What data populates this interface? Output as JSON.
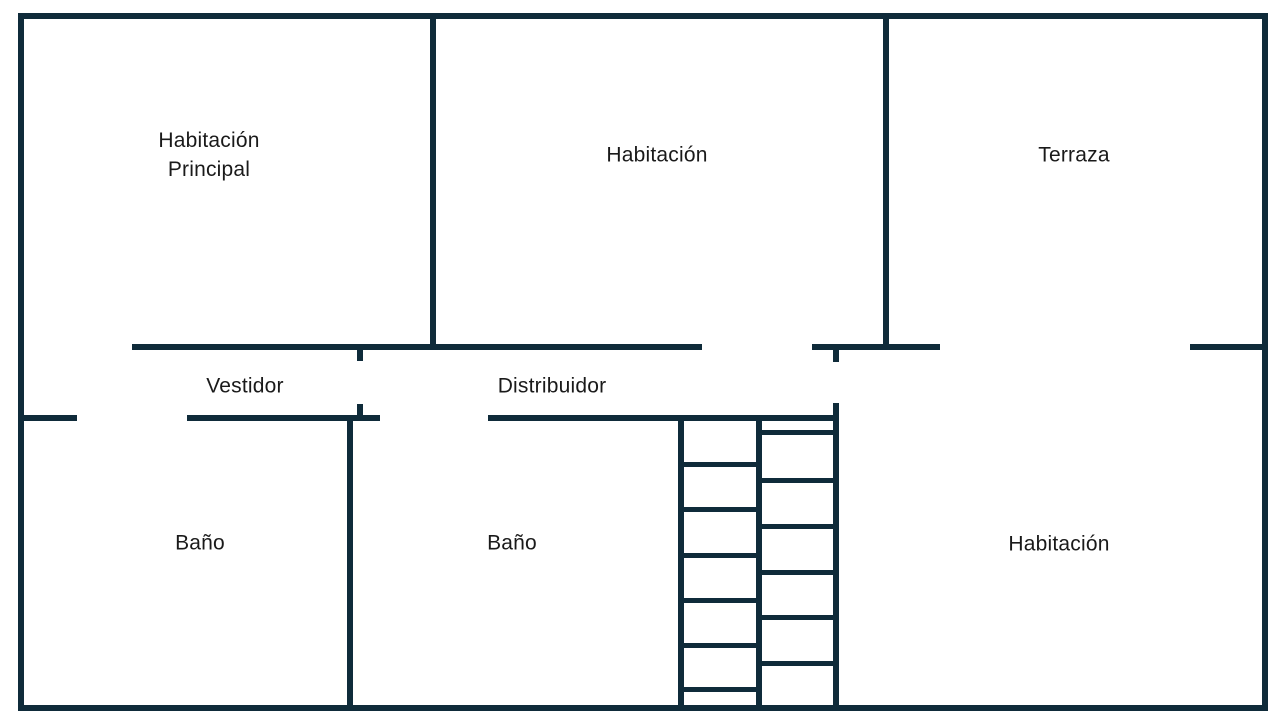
{
  "colors": {
    "wall": "#0F2B3A",
    "label_text": "#1A1A1A",
    "background": "#FFFFFF"
  },
  "rooms": [
    {
      "name": "habitacion-principal",
      "lines": [
        "Habitación",
        "Principal"
      ],
      "cx": 209,
      "cy": 155
    },
    {
      "name": "habitacion-superior",
      "lines": [
        "Habitación"
      ],
      "cx": 657,
      "cy": 155
    },
    {
      "name": "terraza",
      "lines": [
        "Terraza"
      ],
      "cx": 1074,
      "cy": 155
    },
    {
      "name": "vestidor",
      "lines": [
        "Vestidor"
      ],
      "cx": 245,
      "cy": 386
    },
    {
      "name": "distribuidor",
      "lines": [
        "Distribuidor"
      ],
      "cx": 552,
      "cy": 386
    },
    {
      "name": "bano-izquierdo",
      "lines": [
        "Baño"
      ],
      "cx": 200,
      "cy": 543
    },
    {
      "name": "bano-centro",
      "lines": [
        "Baño"
      ],
      "cx": 512,
      "cy": 543
    },
    {
      "name": "habitacion-inferior",
      "lines": [
        "Habitación"
      ],
      "cx": 1059,
      "cy": 544
    }
  ],
  "floorplan": {
    "walls": [
      {
        "name": "outer-wall-top",
        "x": 18,
        "y": 13,
        "w": 1250,
        "h": 6
      },
      {
        "name": "outer-wall-bottom",
        "x": 18,
        "y": 705,
        "w": 1250,
        "h": 6
      },
      {
        "name": "outer-wall-left",
        "x": 18,
        "y": 13,
        "w": 6,
        "h": 698
      },
      {
        "name": "outer-wall-right",
        "x": 1262,
        "y": 13,
        "w": 6,
        "h": 698
      },
      {
        "name": "wall-principal-habitacion",
        "x": 430,
        "y": 13,
        "w": 6,
        "h": 337
      },
      {
        "name": "wall-habitacion-terraza",
        "x": 883,
        "y": 13,
        "w": 6,
        "h": 337
      },
      {
        "name": "wall-toprow-left",
        "x": 132,
        "y": 344,
        "w": 570,
        "h": 6
      },
      {
        "name": "wall-toprow-middle",
        "x": 812,
        "y": 344,
        "w": 128,
        "h": 6
      },
      {
        "name": "wall-toprow-right",
        "x": 1190,
        "y": 344,
        "w": 78,
        "h": 6
      },
      {
        "name": "wall-midrow-left-stub",
        "x": 18,
        "y": 415,
        "w": 59,
        "h": 6
      },
      {
        "name": "wall-midrow-vestidor",
        "x": 187,
        "y": 415,
        "w": 193,
        "h": 6
      },
      {
        "name": "wall-midrow-bano",
        "x": 488,
        "y": 415,
        "w": 351,
        "h": 6
      },
      {
        "name": "wall-bano-divider",
        "x": 347,
        "y": 415,
        "w": 6,
        "h": 296
      },
      {
        "name": "stair-wall-left",
        "x": 678,
        "y": 415,
        "w": 6,
        "h": 296
      },
      {
        "name": "stair-wall-middle",
        "x": 756,
        "y": 415,
        "w": 6,
        "h": 290
      },
      {
        "name": "stair-wall-right",
        "x": 833,
        "y": 403,
        "w": 6,
        "h": 308
      },
      {
        "name": "door-jamb-vestidor-top",
        "x": 357,
        "y": 350,
        "w": 6,
        "h": 11
      },
      {
        "name": "door-jamb-vestidor-bottom",
        "x": 357,
        "y": 404,
        "w": 6,
        "h": 11
      },
      {
        "name": "door-jamb-distribuidor",
        "x": 833,
        "y": 350,
        "w": 6,
        "h": 12
      }
    ],
    "stairs": {
      "columns": [
        {
          "name": "stair-treads-left",
          "x": 684,
          "w": 72,
          "h": 5,
          "tread_y": [
            462,
            507,
            553,
            598,
            643,
            687
          ]
        },
        {
          "name": "stair-treads-right",
          "x": 762,
          "w": 71,
          "h": 5,
          "tread_y": [
            430,
            478,
            524,
            570,
            615,
            661
          ]
        }
      ]
    }
  }
}
